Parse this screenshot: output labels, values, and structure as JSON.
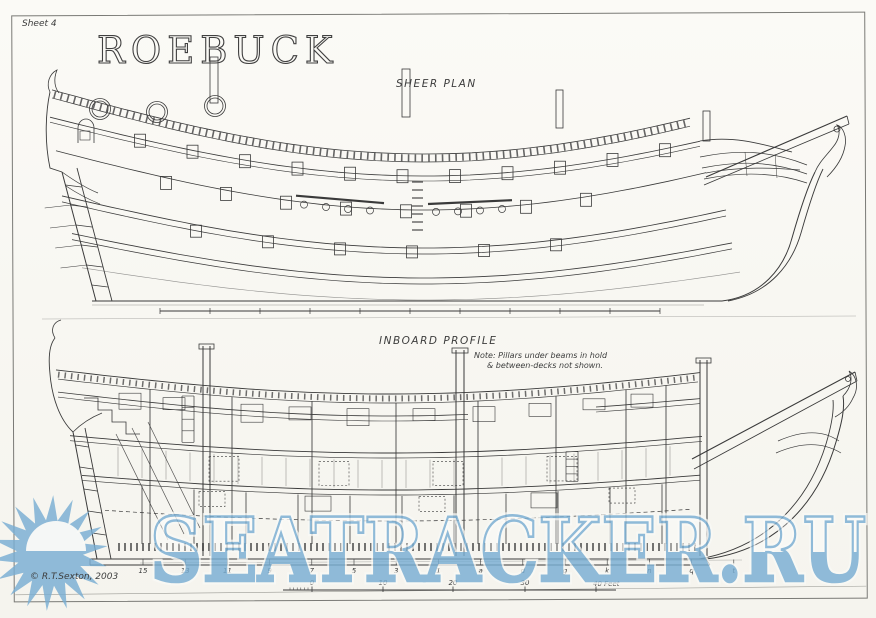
{
  "page": {
    "sheet_label": "Sheet 4",
    "title": "ROEBUCK",
    "copyright": "© R.T.Sexton, 2003"
  },
  "sheer_plan": {
    "label": "SHEER PLAN"
  },
  "inboard_profile": {
    "label": "INBOARD PROFILE",
    "note_line1": "Note:  Pillars under beams in hold",
    "note_line2": "& between-decks not shown.",
    "station_labels": [
      "15",
      "13",
      "11",
      "9",
      "7",
      "5",
      "3",
      "1",
      "a",
      "d",
      "g",
      "k",
      "n",
      "q",
      "t"
    ],
    "scale_labels": [
      "0",
      "10",
      "20",
      "30"
    ],
    "scale_end_label": "40 Feet"
  },
  "watermark": {
    "text": "SEATRACKER.RU",
    "color": "#79aed3"
  }
}
